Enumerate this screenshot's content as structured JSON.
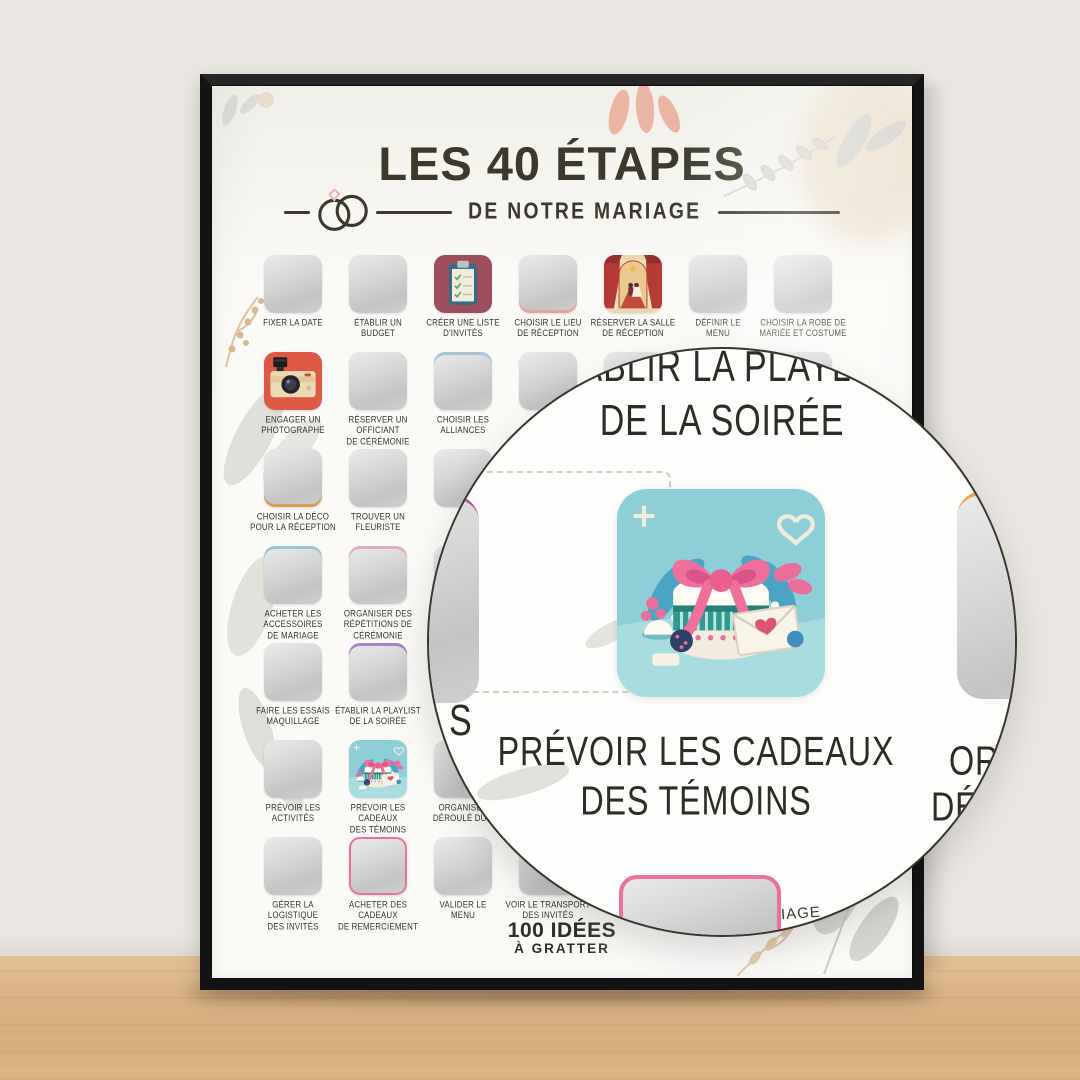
{
  "scene": {
    "wall_color": "#eae7e2",
    "floor_color": "#d9b285",
    "frame_color": "#131313"
  },
  "poster": {
    "title": "LES 40 ÉTAPES",
    "subtitle": "DE NOTRE MARIAGE",
    "title_color": "#3a392c",
    "brand": {
      "line1": "100 IDÉES",
      "line2": "À GRATTER"
    },
    "grid": {
      "rows": [
        {
          "cells": [
            {
              "label": "FIXER LA DATE",
              "state": "unscratched"
            },
            {
              "label": "ÉTABLIR UN\nBUDGET",
              "state": "unscratched"
            },
            {
              "label": "CRÉER UNE LISTE\nD'INVITÉS",
              "state": "scratched",
              "icon": "clipboard-icon"
            },
            {
              "label": "CHOISIR LE LIEU\nDE RÉCEPTION",
              "state": "unscratched",
              "accent_bottom": "#e2a49b"
            },
            {
              "label": "RÉSERVER LA SALLE\nDE RÉCEPTION",
              "state": "scratched",
              "icon": "venue-icon"
            },
            {
              "label": "DÉFINIR LE\nMENU",
              "state": "unscratched"
            },
            {
              "label": "CHOISIR LA ROBE DE\nMARIÉE ET COSTUME",
              "state": "unscratched"
            }
          ]
        },
        {
          "cells": [
            {
              "label": "ENGAGER UN\nPHOTOGRAPHE",
              "state": "scratched",
              "icon": "camera-icon"
            },
            {
              "label": "RÉSERVER UN OFFICIANT\nDE CÉRÉMONIE",
              "state": "unscratched"
            },
            {
              "label": "CHOISIR LES\nALLIANCES",
              "state": "unscratched",
              "accent_top": "#a9c3d6"
            },
            {
              "label": "OR\nS",
              "state": "unscratched"
            },
            {
              "label": "",
              "state": "unscratched"
            },
            {
              "label": "",
              "state": "unscratched"
            },
            {
              "label": "",
              "state": "unscratched"
            }
          ]
        },
        {
          "cells": [
            {
              "label": "CHOISIR LA DÉCO\nPOUR LA RÉCEPTION",
              "state": "unscratched",
              "accent_bottom": "#dd9a55"
            },
            {
              "label": "TROUVER UN\nFLEURISTE",
              "state": "unscratched"
            },
            {
              "label": "",
              "state": "unscratched"
            },
            {
              "label": "",
              "state": "unscratched"
            },
            {
              "label": "",
              "state": "unscratched"
            },
            {
              "label": "",
              "state": "unscratched"
            },
            {
              "label": "",
              "state": "unscratched"
            }
          ]
        },
        {
          "cells": [
            {
              "label": "ACHETER LES ACCESSOIRES\nDE MARIAGE",
              "state": "unscratched",
              "accent_top": "#9fc3d8"
            },
            {
              "label": "ORGANISER DES\nRÉPÉTITIONS DE\nCÉRÉMONIE",
              "state": "unscratched",
              "accent_top": "#e5a9c2"
            },
            {
              "label": "",
              "state": "unscratched"
            },
            {
              "label": "",
              "state": "unscratched"
            },
            {
              "label": "",
              "state": "unscratched"
            },
            {
              "label": "",
              "state": "unscratched"
            },
            {
              "label": "",
              "state": "unscratched"
            }
          ]
        },
        {
          "cells": [
            {
              "label": "FAIRE LES ESSAIS\nMAQUILLAGE",
              "state": "unscratched"
            },
            {
              "label": "ÉTABLIR LA PLAYLIST\nDE LA SOIRÉE",
              "state": "unscratched",
              "accent_top": "#a884bd"
            },
            {
              "label": "",
              "state": "unscratched"
            },
            {
              "label": "",
              "state": "unscratched"
            },
            {
              "label": "",
              "state": "unscratched"
            },
            {
              "label": "",
              "state": "unscratched"
            },
            {
              "label": "",
              "state": "unscratched"
            }
          ]
        },
        {
          "cells": [
            {
              "label": "PRÉVOIR LES\nACTIVITÉS",
              "state": "unscratched"
            },
            {
              "label": "PRÉVOIR LES CADEAUX\nDES TÉMOINS",
              "state": "scratched",
              "icon": "gift-icon"
            },
            {
              "label": "ORGANISER\nDÉROULÉ DU J",
              "state": "unscratched"
            },
            {
              "label": "",
              "state": "unscratched"
            },
            {
              "label": "",
              "state": "unscratched"
            },
            {
              "label": "",
              "state": "unscratched"
            },
            {
              "label": "",
              "state": "unscratched"
            }
          ]
        },
        {
          "cells": [
            {
              "label": "GÉRER LA LOGISTIQUE\nDES INVITÉS",
              "state": "unscratched"
            },
            {
              "label": "ACHETER DES CADEAUX\nDE REMERCIEMENT",
              "state": "unscratched",
              "border": "#ef6f9d"
            },
            {
              "label": "VALIDER LE\nMENU",
              "state": "unscratched"
            },
            {
              "label": "VOIR LE TRANSPORT\nDES INVITÉS",
              "state": "unscratched"
            },
            {
              "label": "",
              "state": "unscratched"
            },
            {
              "label": "",
              "state": "unscratched"
            },
            {
              "label": "",
              "state": "unscratched"
            }
          ]
        }
      ]
    }
  },
  "magnifier": {
    "top_label": {
      "line1": "ÉTABLIR LA PLAYLIST",
      "line2": "DE LA SOIRÉE"
    },
    "main_label": {
      "line1": "PRÉVOIR LES CADEAUX",
      "line2": "DES TÉMOINS"
    },
    "main_icon": "gift-icon",
    "right_fragment": {
      "line1": "OR",
      "line2": "DÉR"
    },
    "left_fragment": "S",
    "bottom_fragment": "IAGE"
  }
}
